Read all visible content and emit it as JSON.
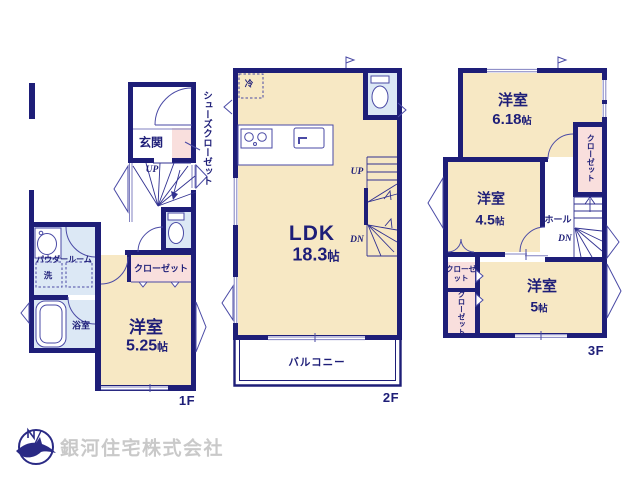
{
  "company": {
    "name": "銀河住宅株式会社"
  },
  "colors": {
    "wall": "#1e1e78",
    "room_fill": "#f7e8c4",
    "wet_area_fill": "#dce8f5",
    "closet_fill": "#f9dfdd",
    "fixture_line": "#4a4aa5",
    "logo_text": "#c9c9c9"
  },
  "floors": {
    "f1": {
      "tag": "1F",
      "entrance": "玄関",
      "shoe_closet": "シューズクローゼット",
      "stairs_up": "UP",
      "powder_room": "パウダールーム",
      "washer": "洗",
      "bathroom": "浴室",
      "closet": "クローゼット",
      "bedroom": {
        "name": "洋室",
        "size": "5.25",
        "unit": "帖"
      }
    },
    "f2": {
      "tag": "2F",
      "fridge": "冷",
      "stairs_up": "UP",
      "stairs_down": "DN",
      "ldk": {
        "name": "LDK",
        "size": "18.3",
        "unit": "帖"
      },
      "balcony": "バルコニー"
    },
    "f3": {
      "tag": "3F",
      "hall": "ホール",
      "stairs_down": "DN",
      "closet_north": "クローゼット",
      "closet_mid": "クローゼット",
      "closet_south": "クローゼット",
      "bedroom_a": {
        "name": "洋室",
        "size": "6.18",
        "unit": "帖"
      },
      "bedroom_b": {
        "name": "洋室",
        "size": "4.5",
        "unit": "帖"
      },
      "bedroom_c": {
        "name": "洋室",
        "size": "5",
        "unit": "帖"
      }
    }
  }
}
